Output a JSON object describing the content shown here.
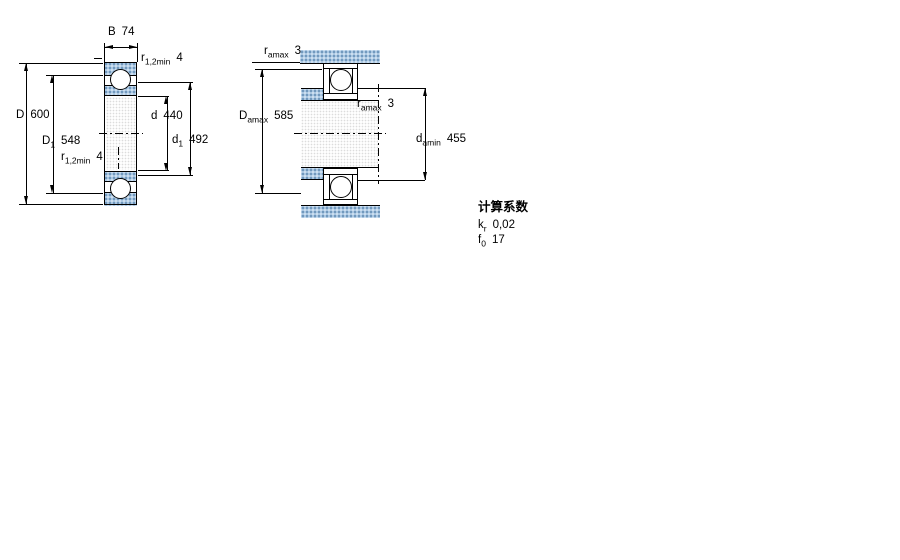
{
  "left_diagram": {
    "dim_B": {
      "base": "B",
      "value": "74"
    },
    "dim_r_top": {
      "base": "r",
      "sub": "1,2min",
      "value": "4"
    },
    "dim_D": {
      "base": "D",
      "value": "600"
    },
    "dim_D1": {
      "base": "D",
      "sub": "1",
      "value": "548"
    },
    "dim_d": {
      "base": "d",
      "value": "440"
    },
    "dim_d1": {
      "base": "d",
      "sub": "1",
      "value": "492"
    },
    "dim_r_bottom": {
      "base": "r",
      "sub": "1,2min",
      "value": "4"
    }
  },
  "right_diagram": {
    "dim_ra_top": {
      "base": "r",
      "sub": "amax",
      "value": "3"
    },
    "dim_Da": {
      "base": "D",
      "sub": "amax",
      "value": "585"
    },
    "dim_ra_mid": {
      "base": "r",
      "sub": "amax",
      "value": "3"
    },
    "dim_da": {
      "base": "d",
      "sub": "amin",
      "value": "455"
    }
  },
  "factors": {
    "heading": "计算系数",
    "rows": [
      {
        "base": "k",
        "sub": "r",
        "value": "0,02"
      },
      {
        "base": "f",
        "sub": "0",
        "value": "17"
      }
    ]
  },
  "colors": {
    "section_hatch_blue": "#aac7e2",
    "hatch_dot_dark": "#6e95ba",
    "line_black": "#000000",
    "background": "#ffffff"
  }
}
